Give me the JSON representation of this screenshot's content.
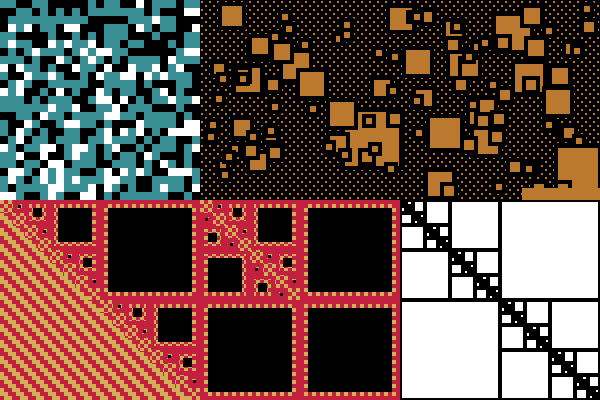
{
  "figure": {
    "title": "fractal-pattern-collage",
    "width": 600,
    "height": 400
  },
  "palette": {
    "teal": "#388e92",
    "black": "#000000",
    "white": "#ffffff",
    "orange": "#bb7930",
    "red": "#c32040",
    "gold": "#d2ae57"
  },
  "panels": {
    "noise_grid": {
      "label": "teal-black-white random cell grid",
      "x": 0,
      "y": 0,
      "w": 200,
      "h": 200,
      "cell": 8,
      "cols": 25,
      "rows": 25,
      "seed": 1337,
      "weight_teal": 0.44,
      "weight_black": 0.38,
      "weight_white": 0.18
    },
    "orange_squares": {
      "label": "orange squares on dotted black field",
      "x": 200,
      "y": 0,
      "w": 400,
      "h": 200,
      "seed": 4242,
      "dot_size": 2,
      "dot_x_pitch": 8,
      "dot_y_pitch": 4,
      "dot_row_offset": 4,
      "halo": 4,
      "fixed_squares": [
        [
          345,
          112,
          54
        ],
        [
          496,
          16,
          34
        ],
        [
          515,
          64,
          28
        ],
        [
          283,
          53,
          26
        ],
        [
          558,
          148,
          40
        ],
        [
          430,
          118,
          30
        ],
        [
          222,
          6,
          20
        ],
        [
          236,
          68,
          24
        ],
        [
          390,
          8,
          22
        ],
        [
          470,
          100,
          24
        ]
      ],
      "random_sizes": [
        [
          24,
          7
        ],
        [
          16,
          13
        ],
        [
          10,
          26
        ],
        [
          6,
          46
        ]
      ],
      "bottom_bar": [
        522,
        188,
        78,
        12
      ]
    },
    "carpet": {
      "label": "red-gold checkered staircase carpet with diagonal stripes",
      "x": 0,
      "y": 200,
      "w": 400,
      "h": 200,
      "module": 4,
      "ring_inset": 4,
      "black_inset": 8,
      "leaf_size": 13,
      "stripe_step": 4,
      "stripe_band": 2
    },
    "staircase": {
      "label": "black-line diagonal staircase fractal on white",
      "x": 400,
      "y": 200,
      "w": 200,
      "h": 200,
      "line": 2,
      "leaf_size": 6
    }
  }
}
